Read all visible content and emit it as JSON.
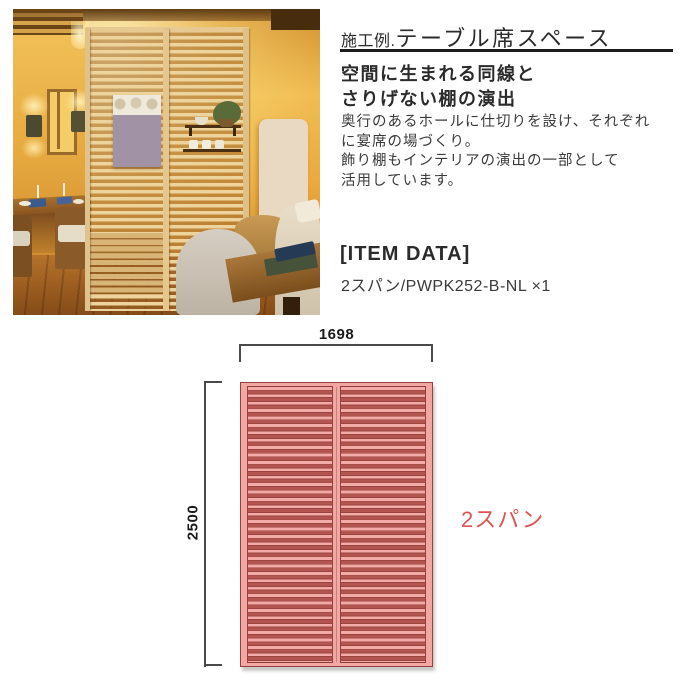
{
  "header": {
    "prefix": "施工例.",
    "title": "テーブル席スペース"
  },
  "description": {
    "heading_lines": [
      "空間に生まれる同線と",
      "さりげない棚の演出"
    ],
    "body_lines": [
      "奥行のあるホールに仕切りを設け、それぞれ",
      "に宴席の場づくり。",
      "飾り棚もインテリアの演出の一部として",
      "活用しています。"
    ]
  },
  "item_data": {
    "heading": "[ITEM DATA]",
    "spec": "2スパン/PWPK252-B-NL ×1"
  },
  "diagram": {
    "type": "dimension-drawing",
    "width_mm": "1698",
    "height_mm": "2500",
    "span_label": "2スパン",
    "spans": 2,
    "colors": {
      "slat_light": "#f3aba7",
      "slat_dark": "#b25551",
      "slat_line": "#9a4341",
      "frame": "#93403e",
      "span_label_red": "#dd5555",
      "dimension_line": "#4a4a4a"
    }
  }
}
